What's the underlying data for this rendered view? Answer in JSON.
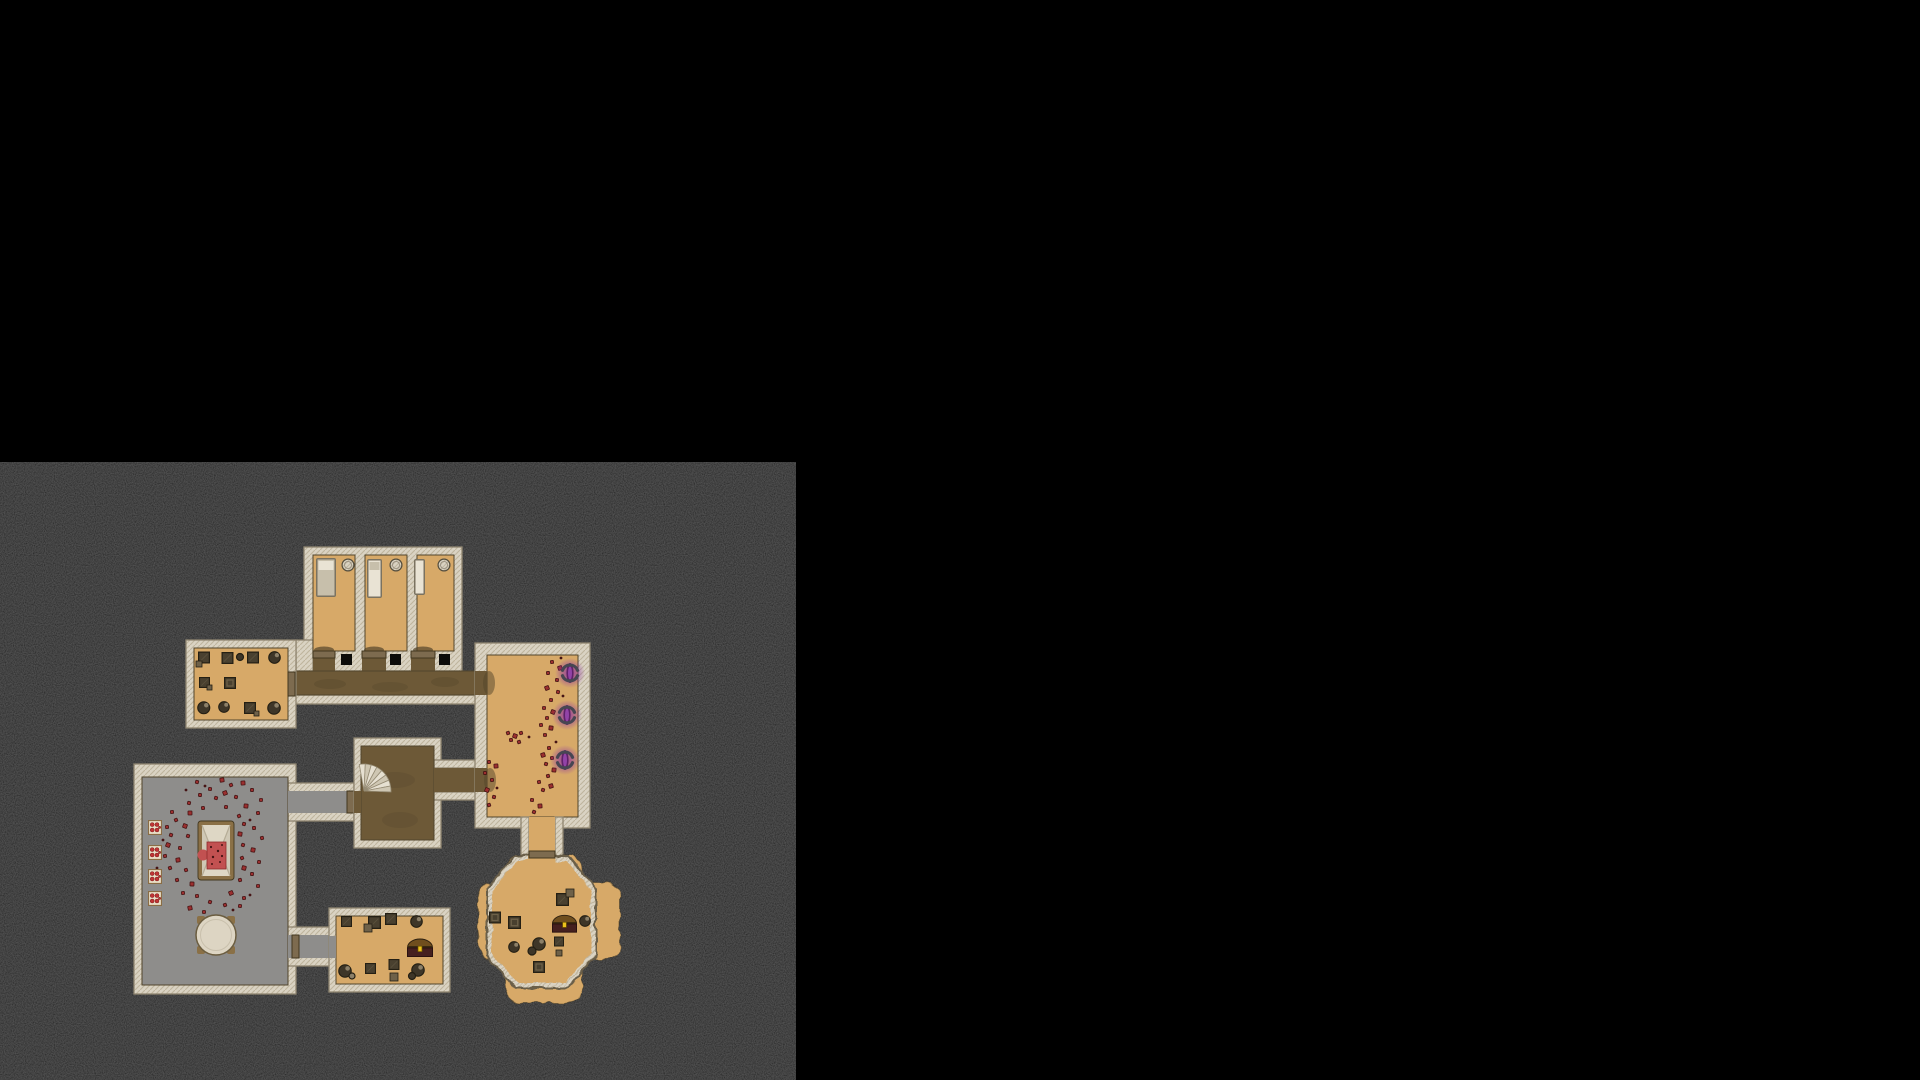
{
  "scene": {
    "type": "top-down-dungeon-battle-map",
    "canvas": {
      "width": 1920,
      "height": 1080
    },
    "ground": {
      "x": 0,
      "y": 462,
      "width": 796,
      "height": 618
    }
  },
  "palette": {
    "void": "#000000",
    "ground": "#121212",
    "speck": "#2e2e2e",
    "wall": "#dad3c3",
    "wall_hatch": "#bfb49d",
    "wall_edge": "#8f8570",
    "floor_line": "#51452c",
    "tan": "#d7a968",
    "dirt": "#6d5937",
    "dirt_dark": "#54452a",
    "gray": "#8e8d8b",
    "door": "#7d6b4f",
    "door_dark": "#42371f",
    "blood": "#9c2f2f",
    "blood_dark": "#451414",
    "blood_bright": "#c25151",
    "purple_glow": "#8a2fa2",
    "purple_core": "#5c1f66",
    "purple_mid": "#9b4ab3",
    "arc": "#474652",
    "chest_dome": "#6f4e1e",
    "chest_band": "#3a2a12",
    "chest_front": "#45201f",
    "chest_latch": "#eac11d",
    "crate": "#49402f",
    "crate_edge": "#241f13",
    "crate_light": "#6e6149",
    "pot": "#3e3628",
    "pot_hi": "#8c8069",
    "bed_frame": "#7a7260",
    "bed_mattress": "#c7bfab",
    "bed_pillow": "#e9e3d4",
    "table_top": "#ddd5c3",
    "wood": "#8a7046",
    "box_bg": "#eadfc7",
    "box_edge": "#8a6d45",
    "box_dot": "#c13434"
  },
  "features": {
    "rooms": [
      {
        "name": "jail-cells",
        "floor": "tan",
        "cells": 3,
        "contents": [
          "bed",
          "barrel",
          "cell-door"
        ]
      },
      {
        "name": "storage-room-west",
        "floor": "tan",
        "contents": [
          "crates",
          "pots"
        ]
      },
      {
        "name": "ritual-room",
        "floor": "gray",
        "contents": [
          "bloody-altar",
          "blood-splatters",
          "supply-boxes",
          "round-table"
        ]
      },
      {
        "name": "stair-room",
        "floor": "dirt",
        "contents": [
          "spiral-staircase"
        ]
      },
      {
        "name": "portal-room",
        "floor": "tan",
        "contents": [
          "purple-braziers",
          "blood-splatters"
        ]
      },
      {
        "name": "cave-chamber",
        "floor": "tan",
        "walls": "scalloped",
        "contents": [
          "treasure-chest",
          "crates",
          "pots"
        ]
      },
      {
        "name": "storage-room-south",
        "floor": "tan",
        "contents": [
          "treasure-chest",
          "crates",
          "pots"
        ]
      }
    ],
    "door_count": 7,
    "brazier_count": 3,
    "chest_count": 2,
    "supply_box_count": 4
  },
  "braziers": [
    {
      "x": 570,
      "y": 673
    },
    {
      "x": 567,
      "y": 715
    },
    {
      "x": 565,
      "y": 760
    }
  ],
  "supply_boxes": [
    {
      "x": 148,
      "y": 820
    },
    {
      "x": 148,
      "y": 845
    },
    {
      "x": 148,
      "y": 869
    },
    {
      "x": 148,
      "y": 891
    }
  ],
  "stair_fan": {
    "cx": 364,
    "cy": 791,
    "r": 27,
    "start": -100,
    "end": 2,
    "wedges": 8
  },
  "splatters": {
    "ritual_room": [
      [
        197,
        782,
        3
      ],
      [
        222,
        780,
        4
      ],
      [
        231,
        785,
        3
      ],
      [
        243,
        783,
        4
      ],
      [
        210,
        789,
        3
      ],
      [
        252,
        790,
        3
      ],
      [
        225,
        793,
        4
      ],
      [
        200,
        795,
        3
      ],
      [
        216,
        798,
        3
      ],
      [
        236,
        797,
        3
      ],
      [
        261,
        800,
        3
      ],
      [
        189,
        803,
        3
      ],
      [
        246,
        806,
        4
      ],
      [
        203,
        808,
        3
      ],
      [
        226,
        807,
        3
      ],
      [
        172,
        812,
        3
      ],
      [
        190,
        813,
        4
      ],
      [
        258,
        813,
        3
      ],
      [
        239,
        816,
        3
      ],
      [
        176,
        820,
        3
      ],
      [
        167,
        827,
        3
      ],
      [
        185,
        826,
        4
      ],
      [
        244,
        824,
        3
      ],
      [
        254,
        828,
        3
      ],
      [
        171,
        835,
        3
      ],
      [
        188,
        836,
        3
      ],
      [
        240,
        834,
        4
      ],
      [
        262,
        838,
        3
      ],
      [
        168,
        845,
        4
      ],
      [
        180,
        848,
        3
      ],
      [
        243,
        845,
        3
      ],
      [
        253,
        850,
        4
      ],
      [
        165,
        856,
        3
      ],
      [
        178,
        860,
        4
      ],
      [
        242,
        858,
        3
      ],
      [
        259,
        862,
        3
      ],
      [
        170,
        868,
        3
      ],
      [
        186,
        870,
        3
      ],
      [
        244,
        868,
        4
      ],
      [
        252,
        874,
        3
      ],
      [
        177,
        880,
        3
      ],
      [
        192,
        884,
        4
      ],
      [
        240,
        880,
        3
      ],
      [
        258,
        886,
        3
      ],
      [
        183,
        893,
        3
      ],
      [
        197,
        896,
        3
      ],
      [
        231,
        893,
        4
      ],
      [
        244,
        898,
        3
      ],
      [
        210,
        902,
        3
      ],
      [
        225,
        905,
        3
      ],
      [
        190,
        908,
        4
      ],
      [
        204,
        912,
        3
      ],
      [
        240,
        906,
        3
      ],
      [
        186,
        790,
        2
      ],
      [
        250,
        820,
        2
      ],
      [
        163,
        840,
        2
      ],
      [
        250,
        895,
        2
      ],
      [
        233,
        910,
        2
      ],
      [
        157,
        868,
        2
      ],
      [
        205,
        786,
        2
      ]
    ],
    "portal_room": [
      [
        552,
        662,
        3
      ],
      [
        560,
        668,
        4
      ],
      [
        548,
        673,
        3
      ],
      [
        557,
        680,
        3
      ],
      [
        547,
        688,
        4
      ],
      [
        558,
        692,
        3
      ],
      [
        551,
        700,
        3
      ],
      [
        544,
        708,
        3
      ],
      [
        553,
        712,
        4
      ],
      [
        547,
        718,
        3
      ],
      [
        541,
        725,
        3
      ],
      [
        551,
        728,
        4
      ],
      [
        545,
        735,
        3
      ],
      [
        508,
        733,
        3
      ],
      [
        515,
        736,
        4
      ],
      [
        521,
        733,
        3
      ],
      [
        511,
        740,
        3
      ],
      [
        519,
        742,
        3
      ],
      [
        549,
        748,
        3
      ],
      [
        543,
        755,
        4
      ],
      [
        552,
        758,
        3
      ],
      [
        546,
        764,
        3
      ],
      [
        554,
        770,
        4
      ],
      [
        548,
        776,
        3
      ],
      [
        539,
        782,
        3
      ],
      [
        551,
        786,
        4
      ],
      [
        543,
        790,
        3
      ],
      [
        489,
        762,
        3
      ],
      [
        496,
        766,
        4
      ],
      [
        485,
        773,
        3
      ],
      [
        492,
        780,
        3
      ],
      [
        487,
        790,
        4
      ],
      [
        494,
        797,
        3
      ],
      [
        489,
        805,
        3
      ],
      [
        532,
        800,
        3
      ],
      [
        540,
        806,
        4
      ],
      [
        534,
        812,
        3
      ],
      [
        561,
        658,
        2
      ],
      [
        563,
        696,
        2
      ],
      [
        556,
        742,
        2
      ],
      [
        529,
        737,
        2
      ],
      [
        497,
        788,
        2
      ]
    ]
  }
}
